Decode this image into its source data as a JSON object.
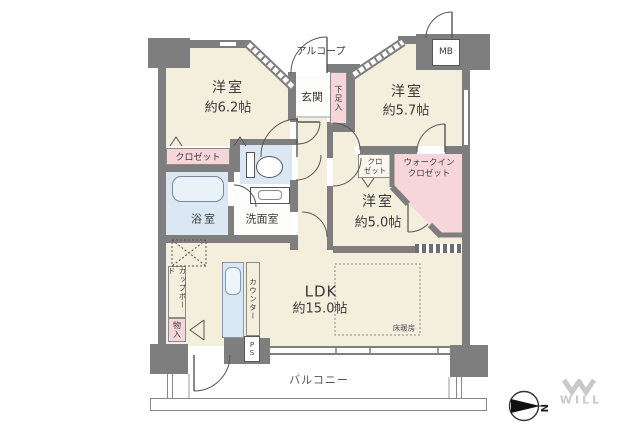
{
  "plan_type": "apartment-floor-plan",
  "labels": {
    "alcove": "アルコープ",
    "entrance": "玄関",
    "shoe_box": "下足入",
    "meter_box": "MB",
    "room1_name": "洋室",
    "room1_size": "約6.2帖",
    "room2_name": "洋室",
    "room2_size": "約5.7帖",
    "room3_name": "洋室",
    "room3_size": "約5.0帖",
    "ldk_name": "LDK",
    "ldk_size": "約15.0帖",
    "closet": "クロゼット",
    "closet_small_line1": "クロ",
    "closet_small_line2": "ゼット",
    "walkin_closet_line1": "ウォークイン",
    "walkin_closet_line2": "クロゼット",
    "bathroom": "浴室",
    "washroom": "洗面室",
    "cupboard": "カップボード",
    "storage": "物入",
    "counter": "カウンター",
    "pipe_space": "PS",
    "floor_heating": "床暖房",
    "balcony": "バルコニー",
    "compass_north": "N",
    "brand": "WILL"
  },
  "colors": {
    "floor": "#f4eedd",
    "closet_pink": "#f7d6db",
    "water_blue": "#dbe8f4",
    "wall_gray": "#7e7e7e",
    "text": "#3a3a3a",
    "brand_gray": "#c9c9c9"
  }
}
